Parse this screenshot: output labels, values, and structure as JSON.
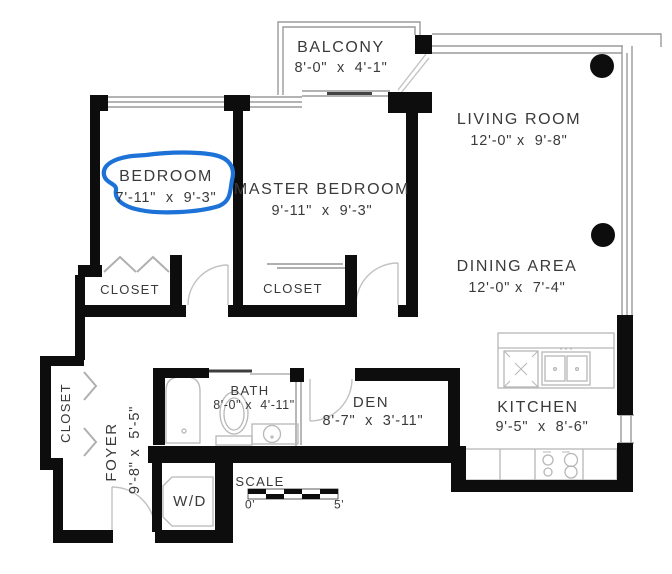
{
  "document": {
    "type": "apartment floor plan"
  },
  "rooms": {
    "balcony": {
      "name": "BALCONY",
      "dims": "8'-0\"  x  4'-1\""
    },
    "living_room": {
      "name": "LIVING ROOM",
      "dims": "12'-0\" x  9'-8\""
    },
    "bedroom": {
      "name": "BEDROOM",
      "dims": "7'-11\"  x  9'-3\""
    },
    "master_bedroom": {
      "name": "MASTER BEDROOM",
      "dims": "9'-11\"  x  9'-3\""
    },
    "dining_area": {
      "name": "DINING AREA",
      "dims": "12'-0\" x  7'-4\""
    },
    "kitchen": {
      "name": "KITCHEN",
      "dims": "9'-5\"  x  8'-6\""
    },
    "den": {
      "name": "DEN",
      "dims": "8'-7\"  x  3'-11\""
    },
    "bath": {
      "name": "BATH",
      "dims": "8'-0\" x  4'-11\""
    },
    "foyer": {
      "name": "FOYER",
      "dims": "9'-8\" x  5'-5\""
    },
    "closet_bedroom": {
      "name": "CLOSET"
    },
    "closet_master": {
      "name": "CLOSET"
    },
    "closet_foyer": {
      "name": "CLOSET"
    },
    "laundry": {
      "name": "W/D"
    }
  },
  "scale_bar": {
    "label": "SCALE",
    "start": "0'",
    "end": "5'"
  },
  "annotation": {
    "kind": "hand-drawn highlight loop",
    "target": "BEDROOM label",
    "color": "#1d72d8"
  }
}
